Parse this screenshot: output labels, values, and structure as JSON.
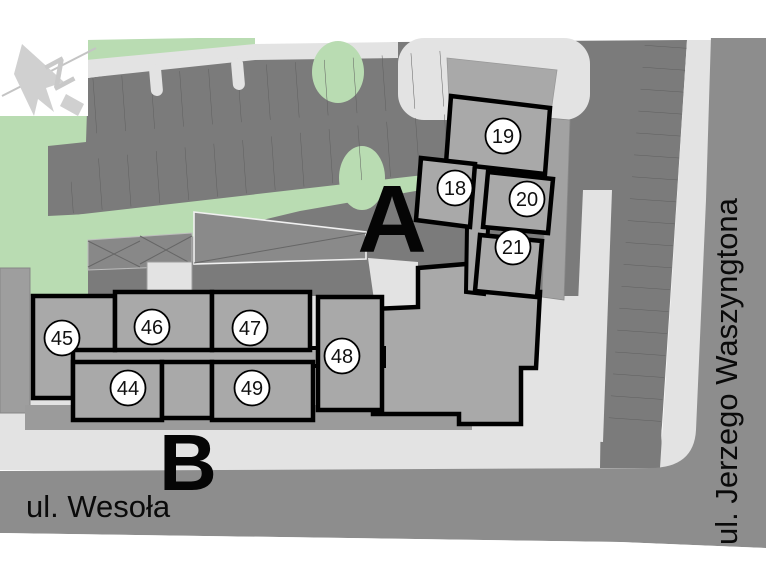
{
  "compass": {
    "label": "Z"
  },
  "buildings": {
    "a": {
      "label": "A"
    },
    "b": {
      "label": "B"
    }
  },
  "units": [
    {
      "number": "18"
    },
    {
      "number": "19"
    },
    {
      "number": "20"
    },
    {
      "number": "21"
    },
    {
      "number": "44"
    },
    {
      "number": "45"
    },
    {
      "number": "46"
    },
    {
      "number": "47"
    },
    {
      "number": "48"
    },
    {
      "number": "49"
    }
  ],
  "streets": {
    "bottom": "ul. Wesoła",
    "right": "ul. Jerzego Waszyngtona"
  },
  "colors": {
    "white": "#ffffff",
    "green": "#b9dcb2",
    "road": "#7b7b7b",
    "street": "#8d8d8d",
    "light": "#e3e3e3",
    "building": "#a9a9a9",
    "shadow": "#9b9b9b",
    "outline": "#000000",
    "stall_line": "#5f5f5f",
    "compass_gray": "#d0d0d0"
  }
}
